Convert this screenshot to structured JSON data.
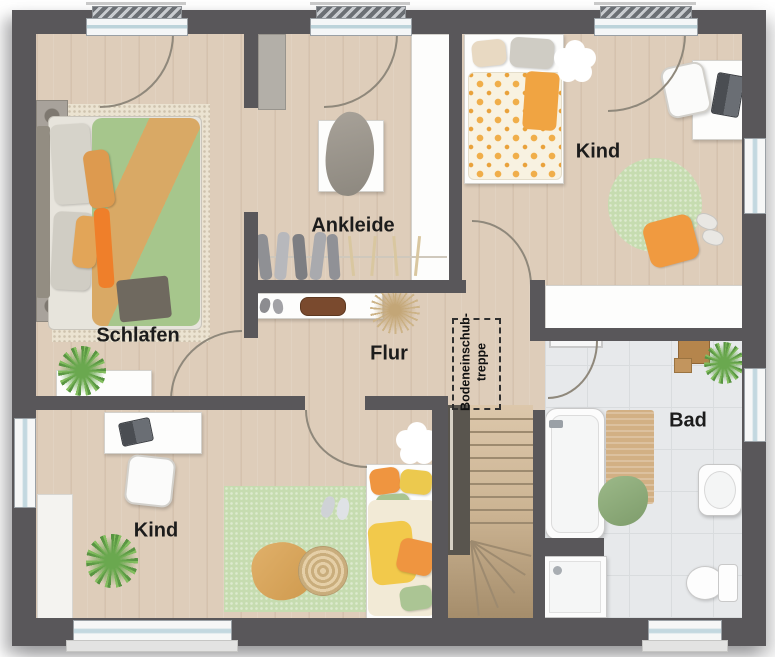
{
  "palette": {
    "wall": "#59575a",
    "wood_floor": "#decdba",
    "stair_wood": "#ccb493",
    "tile_floor": "#e7e9eb",
    "rug_green": "#c6dcb0",
    "duvet_green": "#a6c68c",
    "accent_orange": "#f09a40",
    "white_fixture": "#fdfdfc",
    "label_text": "#1c1c1c"
  },
  "rooms": {
    "schlafen": {
      "label": "Schlafen"
    },
    "ankleide": {
      "label": "Ankleide"
    },
    "kind_top": {
      "label": "Kind"
    },
    "flur": {
      "label": "Flur"
    },
    "kind_bottom": {
      "label": "Kind"
    },
    "bad": {
      "label": "Bad"
    },
    "attic_hatch": {
      "line1": "Bodeneinschub-",
      "line2": "treppe"
    }
  }
}
